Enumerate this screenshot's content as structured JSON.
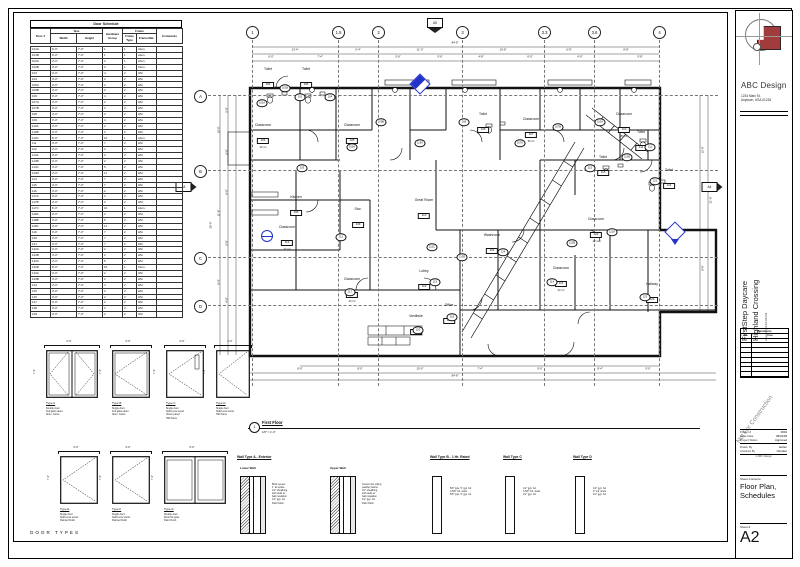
{
  "colors": {
    "accent_red": "#a23b3b",
    "marker_blue": "#2233cc",
    "line": "#111111"
  },
  "sheet": {
    "firm": "ABC Design",
    "address1": "1234 Main St.",
    "address2": "Anytown, USA 01234",
    "project1": "FirstStep Daycare",
    "project2": "Highland Crossing",
    "project_sub": "Anytown, USA 01234",
    "watermark": "Not For Construction",
    "revisions": {
      "title": "Revisions",
      "cols": [
        "No.",
        "Date"
      ],
      "empty_rows": 8
    },
    "fields": [
      {
        "label": "Project #",
        "value": "0601"
      },
      {
        "label": "Issue Date",
        "value": "06/01/06"
      },
      {
        "label": "Project Status",
        "value": "Approved"
      },
      {
        "label": "Drawn By",
        "value": "Author"
      },
      {
        "label": "Checked By",
        "value": "Checker"
      }
    ],
    "footer_note": "© ABC Design",
    "contents_label": "Sheet Contents",
    "contents1": "Floor Plan,",
    "contents2": "Schedules",
    "sheetno_label": "Sheet #",
    "sheetno": "A2"
  },
  "schedule": {
    "title": "Door Schedule",
    "groups": {
      "size": "Size",
      "frame": "Frame"
    },
    "columns": [
      "Door #",
      "Width",
      "Height",
      "Hardware Group",
      "Frame Type",
      "Frame Mat.",
      "Comments"
    ],
    "rows": [
      [
        "101A",
        "6'-0\"",
        "7'-0\"",
        "1",
        "1",
        "Alum.",
        ""
      ],
      [
        "101B",
        "6'-0\"",
        "7'-0\"",
        "1",
        "1",
        "Alum.",
        ""
      ],
      [
        "102A",
        "3'-0\"",
        "7'-0\"",
        "2",
        "1",
        "Alum.",
        ""
      ],
      [
        "102B",
        "3'-0\"",
        "7'-0\"",
        "2",
        "1",
        "Alum.",
        ""
      ],
      [
        "103",
        "3'-0\"",
        "7'-0\"",
        "4",
        "2",
        "HM",
        ""
      ],
      [
        "104",
        "3'-0\"",
        "7'-0\"",
        "2",
        "2",
        "HM",
        ""
      ],
      [
        "105A",
        "3'-0\"",
        "7'-0\"",
        "2",
        "2",
        "HM",
        ""
      ],
      [
        "105B",
        "3'-0\"",
        "7'-0\"",
        "2",
        "2",
        "HM",
        ""
      ],
      [
        "106",
        "3'-0\"",
        "7'-0\"",
        "4",
        "2",
        "HM",
        ""
      ],
      [
        "107A",
        "3'-0\"",
        "7'-0\"",
        "2",
        "2",
        "HM",
        ""
      ],
      [
        "107B",
        "3'-0\"",
        "7'-0\"",
        "2",
        "2",
        "HM",
        ""
      ],
      [
        "108",
        "3'-0\"",
        "7'-0\"",
        "2",
        "2",
        "HM",
        ""
      ],
      [
        "109",
        "3'-0\"",
        "7'-0\"",
        "4",
        "2",
        "HM",
        ""
      ],
      [
        "110A",
        "3'-0\"",
        "7'-0\"",
        "2",
        "2",
        "HM",
        ""
      ],
      [
        "110B",
        "3'-0\"",
        "7'-0\"",
        "2",
        "2",
        "HM",
        ""
      ],
      [
        "110C",
        "6'-0\"",
        "7'-0\"",
        "10",
        "1",
        "Alum.",
        ""
      ],
      [
        "111",
        "3'-0\"",
        "7'-0\"",
        "7",
        "2",
        "HM",
        ""
      ],
      [
        "112",
        "3'-0\"",
        "7'-0\"",
        "2",
        "2",
        "HM",
        ""
      ],
      [
        "113A",
        "3'-0\"",
        "7'-0\"",
        "2",
        "2",
        "HM",
        ""
      ],
      [
        "113B",
        "3'-0\"",
        "7'-0\"",
        "2",
        "2",
        "HM",
        ""
      ],
      [
        "113C",
        "3'-0\"",
        "7'-0\"",
        "5",
        "2",
        "HM",
        ""
      ],
      [
        "113D",
        "3'-0\"",
        "7'-0\"",
        "11",
        "2",
        "HM",
        ""
      ],
      [
        "114",
        "3'-0\"",
        "7'-0\"",
        "7",
        "2",
        "HM",
        ""
      ],
      [
        "115",
        "3'-0\"",
        "7'-0\"",
        "7",
        "2",
        "HM",
        ""
      ],
      [
        "116",
        "3'-0\"",
        "7'-0\"",
        "2",
        "2",
        "HM",
        ""
      ],
      [
        "117A",
        "3'-0\"",
        "7'-0\"",
        "2",
        "2",
        "HM",
        ""
      ],
      [
        "117B",
        "3'-0\"",
        "7'-0\"",
        "2",
        "2",
        "HM",
        ""
      ],
      [
        "117C",
        "6'-0\"",
        "7'-0\"",
        "10",
        "1",
        "Alum.",
        ""
      ],
      [
        "118A",
        "3'-0\"",
        "7'-0\"",
        "2",
        "2",
        "HM",
        ""
      ],
      [
        "118B",
        "3'-0\"",
        "7'-0\"",
        "5",
        "2",
        "HM",
        ""
      ],
      [
        "118C",
        "3'-0\"",
        "7'-0\"",
        "11",
        "2",
        "HM",
        ""
      ],
      [
        "119",
        "3'-0\"",
        "7'-0\"",
        "7",
        "2",
        "HM",
        ""
      ],
      [
        "120",
        "3'-0\"",
        "7'-0\"",
        "7",
        "2",
        "HM",
        ""
      ],
      [
        "121",
        "3'-0\"",
        "7'-0\"",
        "7",
        "2",
        "HM",
        ""
      ],
      [
        "122A",
        "3'-0\"",
        "7'-0\"",
        "2",
        "2",
        "HM",
        ""
      ],
      [
        "122B",
        "3'-0\"",
        "7'-0\"",
        "2",
        "2",
        "HM",
        ""
      ],
      [
        "122C",
        "3'-0\"",
        "7'-0\"",
        "5",
        "2",
        "HM",
        ""
      ],
      [
        "122D",
        "6'-0\"",
        "7'-0\"",
        "10",
        "1",
        "Alum.",
        ""
      ],
      [
        "123A",
        "3'-0\"",
        "7'-0\"",
        "2",
        "2",
        "HM",
        ""
      ],
      [
        "123B",
        "3'-0\"",
        "7'-0\"",
        "2",
        "2",
        "HM",
        ""
      ],
      [
        "124",
        "3'-0\"",
        "7'-0\"",
        "4",
        "2",
        "HM",
        ""
      ],
      [
        "125",
        "3'-0\"",
        "7'-0\"",
        "2",
        "2",
        "HM",
        ""
      ],
      [
        "126",
        "3'-0\"",
        "7'-0\"",
        "2",
        "2",
        "HM",
        ""
      ],
      [
        "127",
        "3'-0\"",
        "7'-0\"",
        "2",
        "2",
        "HM",
        ""
      ],
      [
        "128",
        "3'-0\"",
        "7'-0\"",
        "2",
        "2",
        "HM",
        ""
      ],
      [
        "129",
        "3'-0\"",
        "7'-0\"",
        "2",
        "2",
        "HM",
        ""
      ]
    ]
  },
  "plan": {
    "view_number": "1",
    "view_title": "First Floor",
    "view_scale": "1/8\" = 1'-0\"",
    "grids_top": [
      {
        "label": "1",
        "x": 252
      },
      {
        "label": "1.5",
        "x": 338
      },
      {
        "label": "2",
        "x": 378
      },
      {
        "label": "3",
        "x": 462
      },
      {
        "label": "3.3",
        "x": 544
      },
      {
        "label": "3.6",
        "x": 594
      },
      {
        "label": "4",
        "x": 659
      }
    ],
    "grids_left": [
      {
        "label": "A",
        "y": 95
      },
      {
        "label": "B",
        "y": 170
      },
      {
        "label": "C",
        "y": 257
      },
      {
        "label": "D",
        "y": 305
      }
    ],
    "rooms": [
      {
        "name": "Toilet",
        "num": "102",
        "x": 268,
        "y": 68
      },
      {
        "name": "Toilet",
        "num": "104",
        "x": 306,
        "y": 68
      },
      {
        "name": "Classroom",
        "num": "101",
        "area": "42 m²",
        "x": 263,
        "y": 124
      },
      {
        "name": "Classroom",
        "num": "105",
        "area": "36 m²",
        "x": 352,
        "y": 124
      },
      {
        "name": "Kitchen",
        "num": "103",
        "x": 296,
        "y": 196
      },
      {
        "name": "Classroom",
        "num": "112",
        "area": "22 m²",
        "x": 287,
        "y": 226
      },
      {
        "name": "Stor.",
        "num": "109",
        "x": 358,
        "y": 208
      },
      {
        "name": "Great Room",
        "num": "113",
        "x": 424,
        "y": 199
      },
      {
        "name": "Toilet",
        "num": "106",
        "x": 483,
        "y": 113
      },
      {
        "name": "Classroom",
        "num": "107",
        "area": "36 m²",
        "x": 531,
        "y": 118
      },
      {
        "name": "Classroom",
        "num": "110",
        "area": "87 m²",
        "x": 624,
        "y": 113
      },
      {
        "name": "Toilet",
        "num": "111",
        "x": 641,
        "y": 131
      },
      {
        "name": "Toilet",
        "num": "115",
        "x": 603,
        "y": 156
      },
      {
        "name": "Toilet",
        "num": "121",
        "x": 669,
        "y": 169
      },
      {
        "name": "Classroom",
        "num": "122",
        "area": "42 m²",
        "x": 596,
        "y": 218
      },
      {
        "name": "Washroom",
        "num": "124",
        "x": 492,
        "y": 234
      },
      {
        "name": "Classroom",
        "num": "114",
        "area": "24 m²",
        "x": 561,
        "y": 267
      },
      {
        "name": "Classroom",
        "num": "117",
        "area": "24 m²",
        "x": 352,
        "y": 278
      },
      {
        "name": "Lobby",
        "num": "119",
        "x": 424,
        "y": 270
      },
      {
        "name": "Office",
        "num": "118",
        "x": 449,
        "y": 304
      },
      {
        "name": "Vestibule",
        "num": "120",
        "x": 416,
        "y": 315
      },
      {
        "name": "Hallway",
        "num": "123",
        "x": 652,
        "y": 283
      }
    ],
    "door_tags": [
      {
        "n": "101A",
        "x": 262,
        "y": 103
      },
      {
        "n": "101B",
        "x": 285,
        "y": 88
      },
      {
        "n": "102",
        "x": 300,
        "y": 97
      },
      {
        "n": "104",
        "x": 330,
        "y": 97
      },
      {
        "n": "105A",
        "x": 352,
        "y": 147
      },
      {
        "n": "103",
        "x": 302,
        "y": 168
      },
      {
        "n": "105B",
        "x": 381,
        "y": 122
      },
      {
        "n": "113A",
        "x": 420,
        "y": 143
      },
      {
        "n": "106",
        "x": 464,
        "y": 122
      },
      {
        "n": "107A",
        "x": 520,
        "y": 143
      },
      {
        "n": "107B",
        "x": 558,
        "y": 127
      },
      {
        "n": "110A",
        "x": 600,
        "y": 122
      },
      {
        "n": "110B",
        "x": 627,
        "y": 157
      },
      {
        "n": "111",
        "x": 650,
        "y": 147
      },
      {
        "n": "115",
        "x": 590,
        "y": 168
      },
      {
        "n": "121",
        "x": 655,
        "y": 181
      },
      {
        "n": "122A",
        "x": 612,
        "y": 232
      },
      {
        "n": "122B",
        "x": 572,
        "y": 243
      },
      {
        "n": "124",
        "x": 503,
        "y": 252
      },
      {
        "n": "113B",
        "x": 462,
        "y": 257
      },
      {
        "n": "113C",
        "x": 432,
        "y": 247
      },
      {
        "n": "112",
        "x": 341,
        "y": 237
      },
      {
        "n": "117",
        "x": 350,
        "y": 292
      },
      {
        "n": "118",
        "x": 452,
        "y": 317
      },
      {
        "n": "119",
        "x": 435,
        "y": 282
      },
      {
        "n": "120",
        "x": 418,
        "y": 330
      },
      {
        "n": "123",
        "x": 645,
        "y": 297
      },
      {
        "n": "114",
        "x": 552,
        "y": 282
      }
    ],
    "dims": [
      {
        "x": 455,
        "y": 43,
        "t": "84'-8\""
      },
      {
        "x": 295,
        "y": 50,
        "t": "13'-4\""
      },
      {
        "x": 358,
        "y": 50,
        "t": "5'-4\""
      },
      {
        "x": 420,
        "y": 50,
        "t": "11'-0\""
      },
      {
        "x": 503,
        "y": 50,
        "t": "10'-8\""
      },
      {
        "x": 569,
        "y": 50,
        "t": "6'-8\""
      },
      {
        "x": 626,
        "y": 50,
        "t": "8'-8\""
      },
      {
        "x": 271,
        "y": 57,
        "t": "6'-0\""
      },
      {
        "x": 320,
        "y": 57,
        "t": "7'-4\""
      },
      {
        "x": 398,
        "y": 57,
        "t": "5'-6\""
      },
      {
        "x": 440,
        "y": 57,
        "t": "5'-6\""
      },
      {
        "x": 481,
        "y": 57,
        "t": "4'-8\""
      },
      {
        "x": 530,
        "y": 57,
        "t": "6'-0\""
      },
      {
        "x": 580,
        "y": 57,
        "t": "4'-0\""
      },
      {
        "x": 640,
        "y": 57,
        "t": "5'-8\""
      },
      {
        "x": 300,
        "y": 369,
        "t": "8'-0\""
      },
      {
        "x": 360,
        "y": 369,
        "t": "8'-0\""
      },
      {
        "x": 420,
        "y": 369,
        "t": "10'-0\""
      },
      {
        "x": 480,
        "y": 369,
        "t": "7'-4\""
      },
      {
        "x": 540,
        "y": 369,
        "t": "9'-0\""
      },
      {
        "x": 600,
        "y": 369,
        "t": "8'-4\""
      },
      {
        "x": 648,
        "y": 369,
        "t": "5'-0\""
      },
      {
        "x": 455,
        "y": 376,
        "t": "84'-8\""
      }
    ],
    "dims_rot": [
      {
        "x": 219,
        "y": 130,
        "t": "10'-0\""
      },
      {
        "x": 219,
        "y": 213,
        "t": "11'-6\""
      },
      {
        "x": 219,
        "y": 282,
        "t": "6'-4\""
      },
      {
        "x": 227,
        "y": 110,
        "t": "5'-0\""
      },
      {
        "x": 227,
        "y": 152,
        "t": "5'-0\""
      },
      {
        "x": 227,
        "y": 192,
        "t": "6'-0\""
      },
      {
        "x": 227,
        "y": 243,
        "t": "5'-6\""
      },
      {
        "x": 227,
        "y": 300,
        "t": "4'-8\""
      },
      {
        "x": 211,
        "y": 225,
        "t": "35'-4\""
      },
      {
        "x": 703,
        "y": 150,
        "t": "12'-0\""
      },
      {
        "x": 703,
        "y": 268,
        "t": "9'-6\""
      },
      {
        "x": 711,
        "y": 200,
        "t": "21'-6\""
      }
    ],
    "section_markers": [
      {
        "x": 435,
        "y": 18,
        "dir": "down",
        "sheet": "A5"
      },
      {
        "x": 186,
        "y": 182,
        "dir": "right",
        "sheet": "A5"
      },
      {
        "x": 712,
        "y": 182,
        "dir": "right",
        "sheet": "A4"
      }
    ],
    "elev_markers": [
      {
        "x": 420,
        "y": 84,
        "type": "diamond"
      },
      {
        "x": 675,
        "y": 232,
        "type": "diamond-down"
      },
      {
        "x": 267,
        "y": 236,
        "type": "circle"
      }
    ]
  },
  "door_types": {
    "caption": "DOOR TYPES",
    "height_dim": "7'-0\"",
    "items": [
      {
        "label": "Type A",
        "x": 38,
        "y": 340,
        "w": 62,
        "dim": "6'-0\"",
        "style": "double-glass",
        "notes": [
          "Double door",
          "Full glass alum.",
          "Alum. frame"
        ]
      },
      {
        "label": "Type B",
        "x": 104,
        "y": 340,
        "w": 48,
        "dim": "3'-0\"",
        "style": "single-glass",
        "notes": [
          "Single door",
          "Full glass alum.",
          "Alum. frame"
        ]
      },
      {
        "label": "Type C",
        "x": 158,
        "y": 340,
        "w": 48,
        "dim": "3'-0\"",
        "style": "vision",
        "notes": [
          "Single door",
          "Solid core wood",
          "Vision panel",
          "HM frame"
        ]
      },
      {
        "label": "Type D",
        "x": 208,
        "y": 340,
        "w": 44,
        "dim": "3'-0\"",
        "style": "flush",
        "notes": [
          "Single door",
          "Solid core wood",
          "HM frame"
        ]
      },
      {
        "label": "Type E",
        "x": 52,
        "y": 446,
        "w": 48,
        "dim": "3'-0\"",
        "style": "swing",
        "notes": [
          "Single door",
          "Solid core wood",
          "Painted finish"
        ]
      },
      {
        "label": "Type F",
        "x": 104,
        "y": 446,
        "w": 48,
        "dim": "3'-0\"",
        "style": "swing",
        "notes": [
          "Single door",
          "Solid core wood",
          "Painted finish"
        ]
      },
      {
        "label": "Type G",
        "x": 156,
        "y": 446,
        "w": 72,
        "dim": "6'-0\"",
        "style": "bipass",
        "notes": [
          "Double door",
          "Wood bi-pass",
          "Paint finish"
        ]
      }
    ]
  },
  "wall_types": {
    "items": [
      {
        "title": "Wall Type A - Exterior",
        "x": 237,
        "y": 455,
        "assemblies": [
          {
            "label": "Lower Wall",
            "x": 240,
            "wall": "exterior",
            "notes": [
              "Brick veneer",
              "1\" air space",
              "1/2\" sheathing",
              "2x6 studs w/",
              "batt insulation",
              "1/2\" gyp. bd.",
              "Paint finish"
            ]
          },
          {
            "label": "Upper Wall",
            "x": 330,
            "wall": "exterior",
            "notes": [
              "Cement bd. siding",
              "weather barrier",
              "1/2\" sheathing",
              "2x6 studs w/",
              "batt insulation",
              "1/2\" gyp. bd.",
              "Paint finish"
            ]
          }
        ]
      },
      {
        "title": "Wall Type B - 1 Hr. Rated",
        "x": 430,
        "y": 455,
        "assemblies": [
          {
            "label": "",
            "x": 432,
            "wall": "stud",
            "notes": [
              "5/8\" type 'X' gyp. bd.",
              "3-5/8\" mtl. studs",
              "5/8\" type 'X' gyp. bd."
            ]
          }
        ]
      },
      {
        "title": "Wall Type C",
        "x": 503,
        "y": 455,
        "assemblies": [
          {
            "label": "",
            "x": 505,
            "wall": "stud",
            "notes": [
              "1/2\" gyp. bd.",
              "3-5/8\" mtl. studs",
              "1/2\" gyp. bd."
            ]
          }
        ]
      },
      {
        "title": "Wall Type D",
        "x": 573,
        "y": 455,
        "assemblies": [
          {
            "label": "",
            "x": 575,
            "wall": "stud",
            "notes": [
              "1/2\" gyp. bd.",
              "6\" mtl. studs",
              "1/2\" gyp. bd."
            ]
          }
        ]
      }
    ]
  }
}
